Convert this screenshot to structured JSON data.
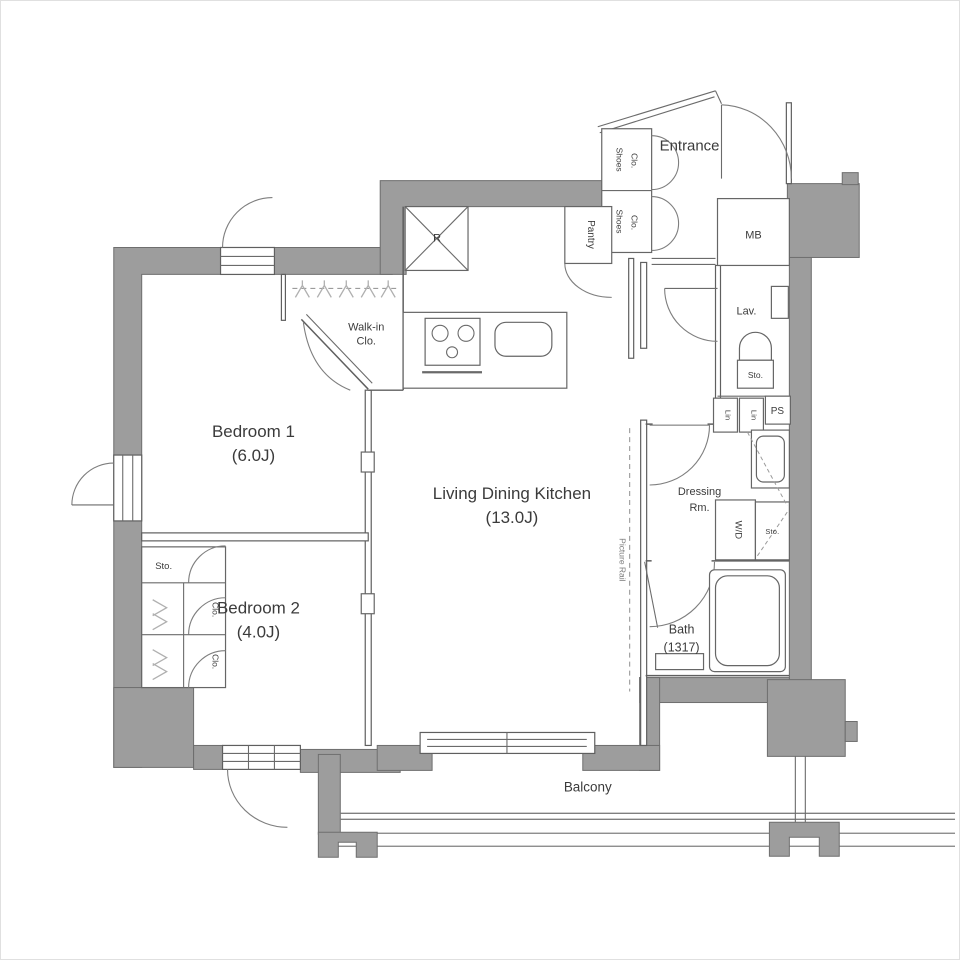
{
  "plan": {
    "rooms": {
      "bedroom1": {
        "name": "Bedroom 1",
        "size": "(6.0J)"
      },
      "bedroom2": {
        "name": "Bedroom 2",
        "size": "(4.0J)"
      },
      "ldk": {
        "name": "Living Dining Kitchen",
        "size": "(13.0J)"
      },
      "entrance": {
        "name": "Entrance"
      },
      "balcony": {
        "name": "Balcony"
      },
      "walkin": {
        "line1": "Walk-in",
        "line2": "Clo."
      },
      "dressing": {
        "line1": "Dressing",
        "line2": "Rm."
      },
      "bath": {
        "name": "Bath",
        "size": "(1317)"
      },
      "lav": {
        "name": "Lav."
      },
      "mb": {
        "name": "MB"
      },
      "ps": {
        "name": "PS"
      },
      "pantry": {
        "name": "Pantry"
      },
      "wd": {
        "name": "W/D"
      }
    },
    "closets": {
      "shoes1": {
        "line1": "Shoes",
        "line2": "Clo."
      },
      "shoes2": {
        "line1": "Shoes",
        "line2": "Clo."
      },
      "sto_lav": "Sto.",
      "sto_dressing": "Sto.",
      "sto_bedroom2": "Sto.",
      "clo_upper": "Clo.",
      "clo_lower": "Clo.",
      "lin1": "Lin",
      "lin2": "Lin"
    },
    "annotations": {
      "fridge": "R",
      "picture_rail": "Picture Rail"
    },
    "colors": {
      "wall": "#9d9d9d",
      "wall_border": "#6e6e6e",
      "line": "#5f5f5f",
      "text": "#3b3b3b"
    }
  }
}
